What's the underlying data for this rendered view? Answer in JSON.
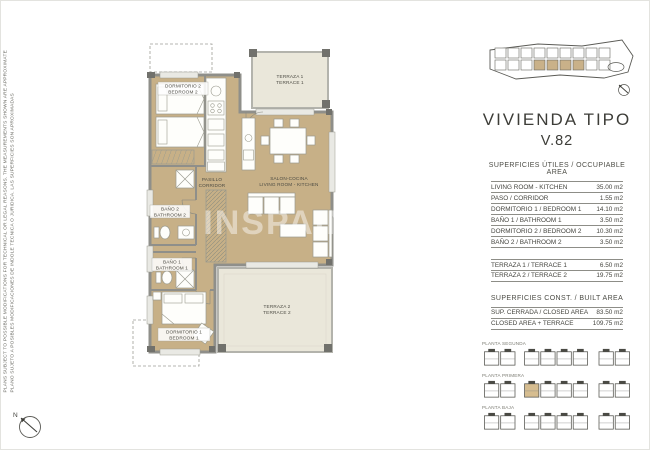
{
  "disclaimer": {
    "line1": "PLANS SUBJECT TO POSSIBLE MODIFICATIONS FOR TECHNICAL OR LEGAL REASONS. THE MEASUREMENTS SHOWN ARE APPROXIMATE",
    "line2": "PLANO SUJETO A POSIBLES MODIFICACIONES DE INDOLE TECNICA O JURIDICA. LAS SUPERFICIES SON APROXIMADAS"
  },
  "compass": {
    "label": "N"
  },
  "watermark": "INSPAIN",
  "colors": {
    "interior_tan": "#c7b087",
    "terrace_beige": "#eae7da",
    "wall_gray": "#8f8f8a",
    "highlight_unit": "#d6bd90"
  },
  "plan": {
    "rooms": {
      "bedroom2": {
        "es": "DORMITORIO 2",
        "en": "BEDROOM 2"
      },
      "terrace1": {
        "es": "TERRAZA 1",
        "en": "TERRACE 1"
      },
      "corridor": {
        "es": "PASILLO",
        "en": "CORRIDOR"
      },
      "living": {
        "es": "SALON-COCINA",
        "en": "LIVING ROOM - KITCHEN"
      },
      "bath2": {
        "es": "BAÑO 2",
        "en": "BATHROOM 2"
      },
      "bath1": {
        "es": "BAÑO 1",
        "en": "BATHROOM 1"
      },
      "bedroom1": {
        "es": "DORMITORIO 1",
        "en": "BEDROOM 1"
      },
      "terrace2": {
        "es": "TERRAZA 2",
        "en": "TERRACE 2"
      }
    }
  },
  "panel": {
    "title": "VIVIENDA TIPO",
    "subtitle": "V.82",
    "useful_header": "SUPERFICIES ÚTILES / OCCUPIABLE AREA",
    "built_header": "SUPERFICIES  CONST. / BUILT AREA",
    "useful_rows": [
      {
        "label": "LIVING ROOM - KITCHEN",
        "value": "35.00 m2"
      },
      {
        "label": "PASO / CORRIDOR",
        "value": "1.55 m2"
      },
      {
        "label": "DORMITORIO 1 /  BEDROOM 1",
        "value": "14.10 m2"
      },
      {
        "label": "BAÑO 1 / BATHROOM 1",
        "value": "3.50 m2"
      },
      {
        "label": "DORMITORIO 2 / BEDROOM 2",
        "value": "10.30 m2"
      },
      {
        "label": "BAÑO 2 / BATHROOM 2",
        "value": "3.50 m2"
      }
    ],
    "terrace_rows": [
      {
        "label": "TERRAZA 1 / TERRACE 1",
        "value": "6.50 m2"
      },
      {
        "label": "TERRAZA 2 / TERRACE 2",
        "value": "19.75 m2"
      }
    ],
    "built_rows": [
      {
        "label": "SUP. CERRADA / CLOSED AREA",
        "value": "83.50 m2"
      },
      {
        "label": "CLOSED AREA + TERRACE",
        "value": "109.75 m2"
      }
    ],
    "floors": [
      {
        "label": "PLANTA SEGUNDA",
        "highlighted_unit": null
      },
      {
        "label": "PLANTA PRIMERA",
        "highlighted_unit": 2
      },
      {
        "label": "PLANTA BAJA",
        "highlighted_unit": null
      }
    ]
  }
}
